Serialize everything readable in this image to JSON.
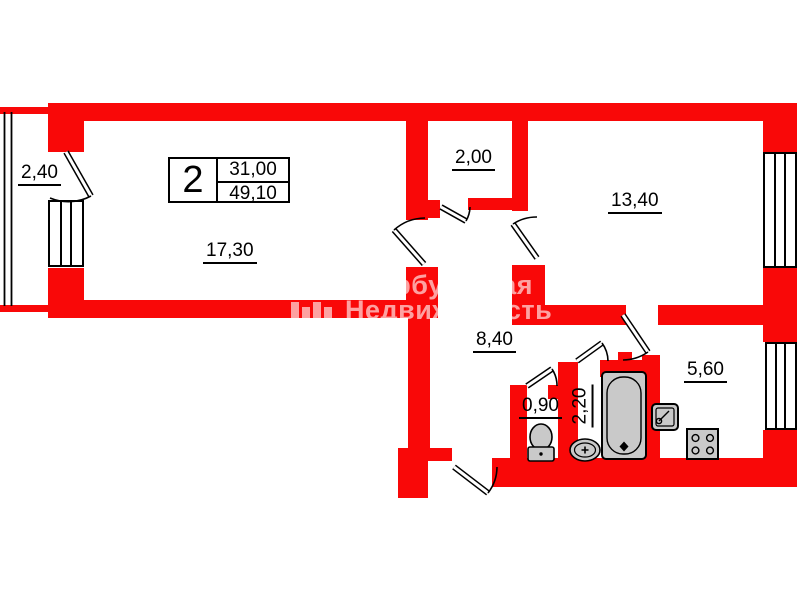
{
  "title_block": {
    "room_count": "2",
    "living_area": "31,00",
    "total_area": "49,10"
  },
  "rooms": {
    "balcony": "2,40",
    "living_room": "17,30",
    "storage": "2,00",
    "bedroom": "13,40",
    "hallway": "8,40",
    "wc": "0,90",
    "bathroom": "2,20",
    "kitchen": "5,60"
  },
  "watermark": {
    "line1": "Петербургская",
    "line2": "Недвижимость",
    "logo": "bars-logo"
  },
  "fixtures": [
    "bathtub",
    "toilet",
    "wash-basin",
    "kitchen-sink",
    "stove"
  ],
  "colors": {
    "wall_red": "#F90808",
    "fixture_gray": "#C9C9C9",
    "line_black": "#000000",
    "watermark_tint": "rgba(255,255,255,0.62)"
  }
}
